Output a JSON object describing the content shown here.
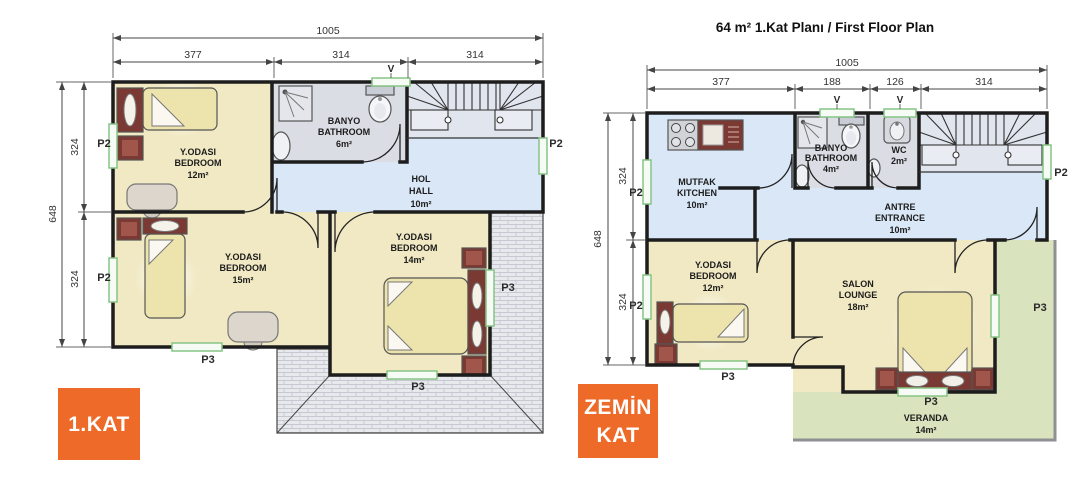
{
  "title": {
    "right_plan": "64 m²  1.Kat Planı / First Floor Plan"
  },
  "badges": {
    "first_floor": "1.KAT",
    "ground_floor_line1": "ZEMİN",
    "ground_floor_line2": "KAT"
  },
  "markers": {
    "p2": "P2",
    "p3": "P3",
    "v": "V"
  },
  "colors": {
    "accent_orange": "#EE6A28",
    "room_yellow": "#F1E9C3",
    "hall_blue": "#D9E7F6",
    "bath_gray": "#DBDDE4",
    "stairs_gray": "#E1E5EE",
    "veranda_green": "#D9E3BD",
    "roof_gray": "#E8E9ED",
    "furniture_red": "#7A3A33",
    "bed_yellow": "#EDE3AC",
    "window_green": "#85C585",
    "wall_black": "#1D1D1D"
  },
  "left_plan": {
    "dims_top": [
      "1005",
      "377",
      "314",
      "314"
    ],
    "dims_side": [
      "648",
      "324",
      "324"
    ],
    "rooms": {
      "bedroom12": {
        "name": "Y.ODASI",
        "en": "BEDROOM",
        "area": "12m²"
      },
      "bathroom": {
        "name": "BANYO",
        "en": "BATHROOM",
        "area": "6m²"
      },
      "hall": {
        "name": "HOL",
        "en": "HALL",
        "area": "10m²"
      },
      "bedroom15": {
        "name": "Y.ODASI",
        "en": "BEDROOM",
        "area": "15m²"
      },
      "bedroom14": {
        "name": "Y.ODASI",
        "en": "BEDROOM",
        "area": "14m²"
      }
    }
  },
  "right_plan": {
    "dims_top": [
      "1005",
      "377",
      "188",
      "126",
      "314"
    ],
    "dims_side": [
      "648",
      "324",
      "324"
    ],
    "rooms": {
      "kitchen": {
        "name": "MUTFAK",
        "en": "KITCHEN",
        "area": "10m²"
      },
      "bathroom": {
        "name": "BANYO",
        "en": "BATHROOM",
        "area": "4m²"
      },
      "wc": {
        "name": "WC",
        "area": "2m²"
      },
      "entrance": {
        "name": "ANTRE",
        "en": "ENTRANCE",
        "area": "10m²"
      },
      "bedroom12": {
        "name": "Y.ODASI",
        "en": "BEDROOM",
        "area": "12m²"
      },
      "lounge": {
        "name": "SALON",
        "en": "LOUNGE",
        "area": "18m²"
      },
      "veranda": {
        "name": "VERANDA",
        "area": "14m²"
      }
    }
  }
}
